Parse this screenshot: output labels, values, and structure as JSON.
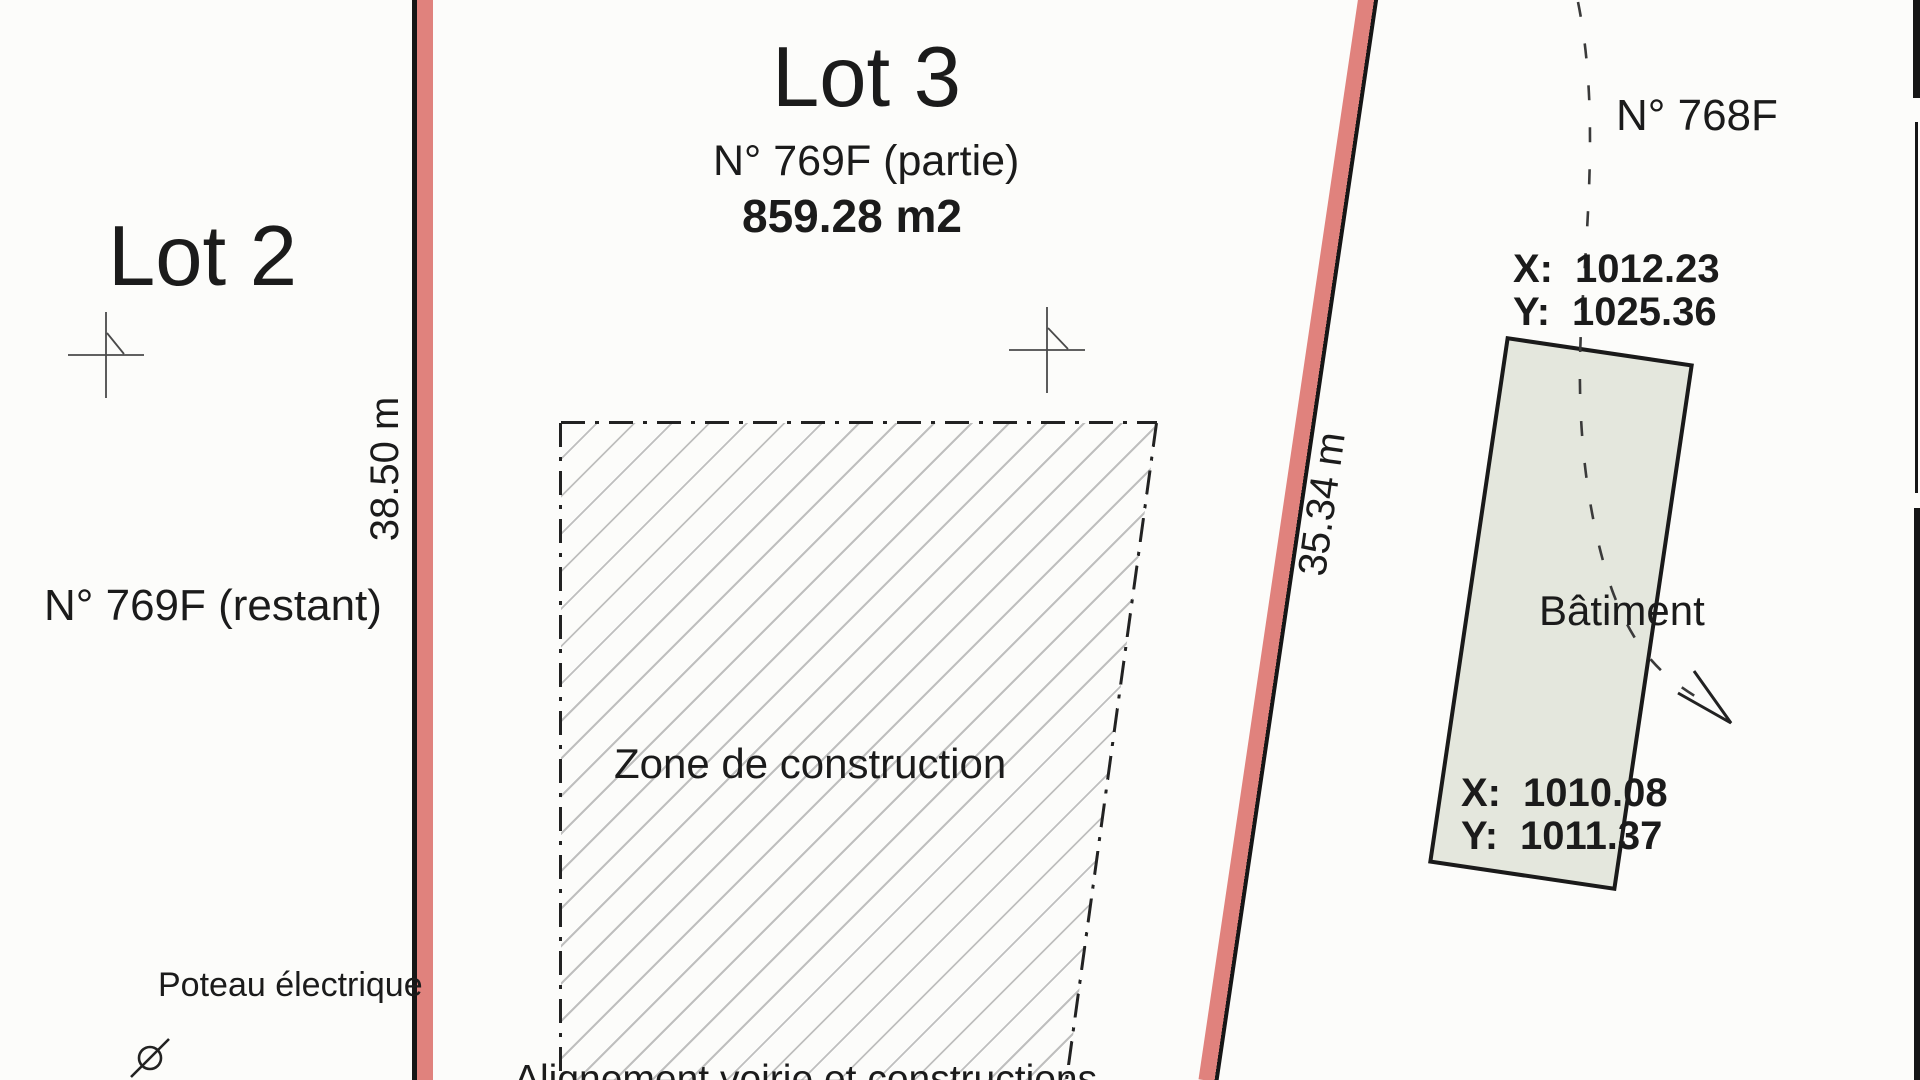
{
  "plan": {
    "lot2": {
      "title": "Lot 2",
      "parcel": "N° 769F (restant)"
    },
    "lot3": {
      "title": "Lot 3",
      "parcel": "N° 769F (partie)",
      "area": "859.28 m2"
    },
    "neighbor": {
      "parcel": "N° 768F"
    },
    "zone": {
      "label": "Zone de construction"
    },
    "building": {
      "label": "Bâtiment",
      "corner_top": {
        "x_label": "X:",
        "x_value": "1012.23",
        "y_label": "Y:",
        "y_value": "1025.36"
      },
      "corner_bottom": {
        "x_label": "X:",
        "x_value": "1010.08",
        "y_label": "Y:",
        "y_value": "1011.37"
      }
    },
    "dimensions": {
      "left_boundary": "38.50 m",
      "right_boundary": "35.34 m"
    },
    "annotations": {
      "pole": "Poteau électrique",
      "alignment": "Alignement voirie et constructions"
    },
    "colors": {
      "boundary_red": "#e0827d",
      "building_fill": "#e4e7dd",
      "hatch_gray": "#b4b4b4",
      "line_black": "#161616"
    }
  }
}
